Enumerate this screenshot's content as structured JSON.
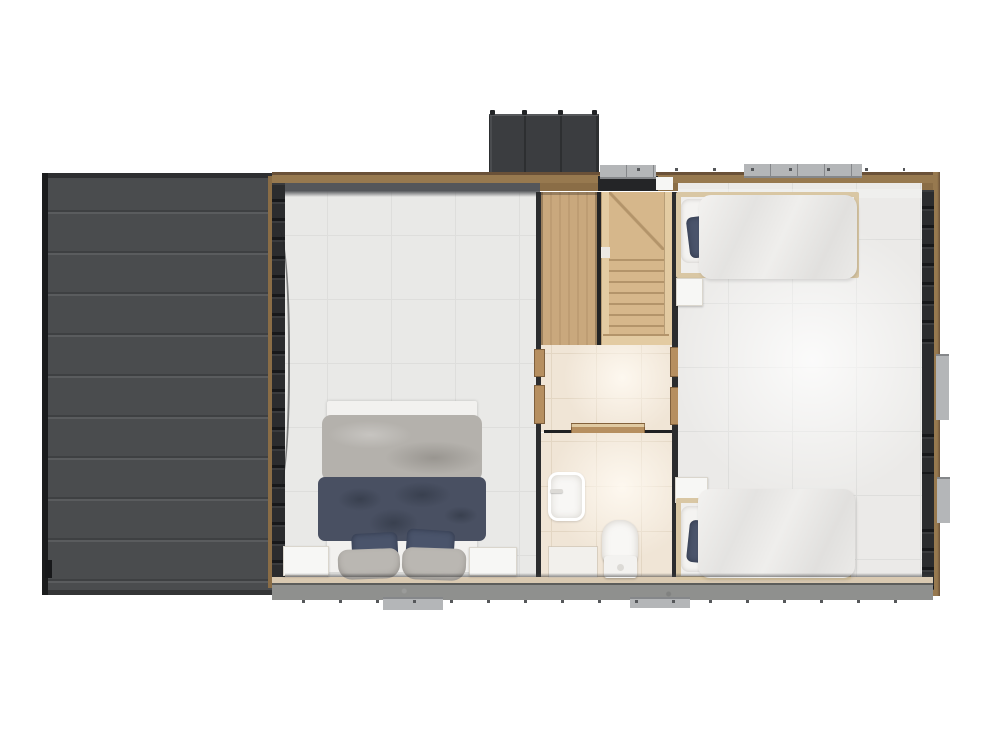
{
  "scene": {
    "type": "floor-plan-render",
    "view": "top-down",
    "areas": [
      {
        "name": "side-deck",
        "description": "dark slatted terrace deck on left"
      },
      {
        "name": "double-bedroom",
        "furniture": [
          "double-bed",
          "nightstand-left",
          "nightstand-right"
        ]
      },
      {
        "name": "stair-core",
        "furniture": [
          "wardrobe",
          "winder-staircase"
        ]
      },
      {
        "name": "hallway",
        "furniture": [
          "sliding-door"
        ]
      },
      {
        "name": "bathroom",
        "furniture": [
          "sink",
          "toilet",
          "bath-mat"
        ]
      },
      {
        "name": "twin-bedroom",
        "furniture": [
          "single-bed-top",
          "single-bed-bottom",
          "nightstand-top",
          "nightstand-bottom"
        ]
      },
      {
        "name": "exterior",
        "elements": [
          "privacy-screen",
          "ac-unit",
          "window-frames",
          "fastener-dots"
        ]
      }
    ]
  },
  "palette": {
    "bg": "#ffffff",
    "deck": "#4a4c4e",
    "deck-line-dark": "#3e4042",
    "deck-line-light": "#5a5c5e",
    "deck-edge": "#1b1c1d",
    "deck-top": "#2e2f31",
    "screen": "#3b3d40",
    "screen-line": "#2d2f31",
    "screen-hl": "#56585b",
    "screen-post": "#232527",
    "wall-wood": "#97794f",
    "wall-wood-2": "#8a6d46",
    "wall-wood-dark": "#6a5138",
    "wall-shadow": "#54565a",
    "wall-dark": "#2b2c2e",
    "wall-notch": "#17181a",
    "wood-door": "#b68f60",
    "gray-unit": "#b4b6b8",
    "gray-unit-dark": "#85878a",
    "dot": "#55575a",
    "bottom-tan": "#d9c9b1",
    "bottom-gray": "#8f908e",
    "floor-left": "#e9e9e7",
    "floor-right": "#ebeae8",
    "tile-line": "#dededc",
    "floor-bath": "#f0e5d6",
    "bath-line": "#e3d6c3",
    "wardrobe": "#c9a87d",
    "stairs": "#d6b78b",
    "stair-line": "#b3946a",
    "stringer": "#e3cba2",
    "track": "#1f2022",
    "white-fixture": "#f8f7f5",
    "bed-frame": "#f2f1ef",
    "duvet-gray": "#b4b1ac",
    "blanket-navy": "#495062",
    "blanket-navy-dark": "#39404f",
    "pillow-navy": "#4a546b",
    "pillow-gray": "#bab7b2",
    "nightstand": "#f7f7f5",
    "single-frame": "#d9c7a4",
    "single-duvet": "#edecea"
  }
}
